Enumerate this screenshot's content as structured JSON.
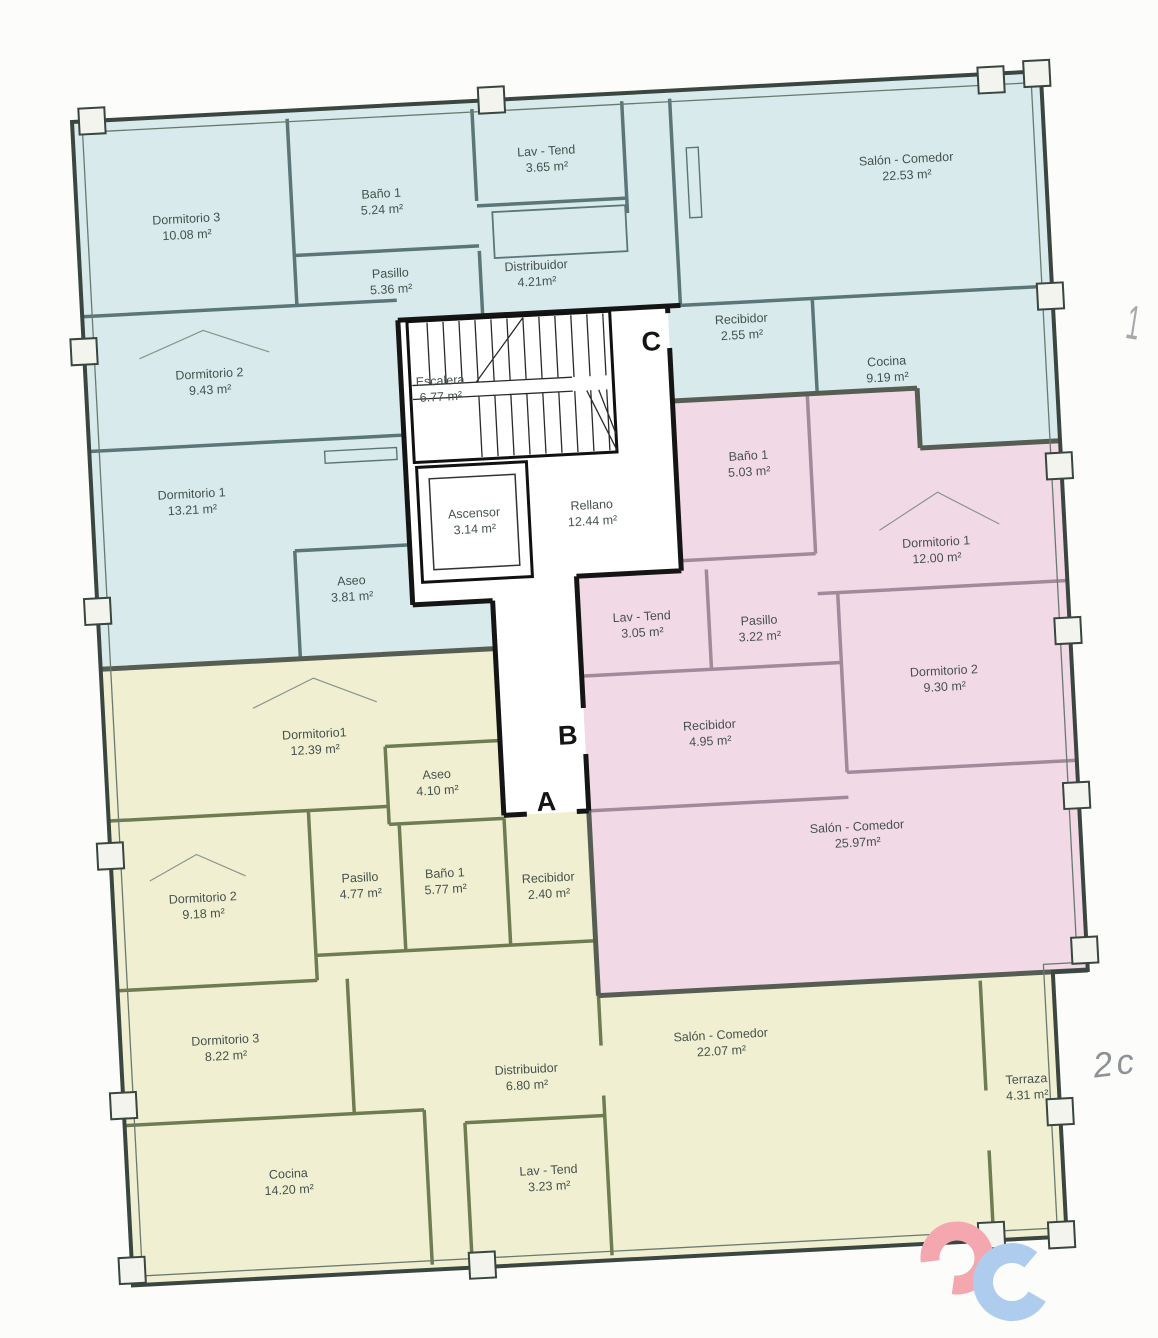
{
  "plan": {
    "letters": {
      "a": "A",
      "b": "B",
      "c": "C"
    },
    "core": {
      "rooms": [
        {
          "name": "Escalera",
          "area": "6.77 m²"
        },
        {
          "name": "Ascensor",
          "area": "3.14 m²"
        },
        {
          "name": "Rellano",
          "area": "12.44 m²"
        }
      ]
    },
    "apartment_c": {
      "fill": "#d9eaec",
      "rooms": [
        {
          "name": "Dormitorio 3",
          "area": "10.08 m²"
        },
        {
          "name": "Baño 1",
          "area": "5.24 m²"
        },
        {
          "name": "Lav - Tend",
          "area": "3.65 m²"
        },
        {
          "name": "Salón - Comedor",
          "area": "22.53 m²"
        },
        {
          "name": "Pasillo",
          "area": "5.36 m²"
        },
        {
          "name": "Distribuidor",
          "area": "4.21m²"
        },
        {
          "name": "Recibidor",
          "area": "2.55 m²"
        },
        {
          "name": "Cocina",
          "area": "9.19 m²"
        },
        {
          "name": "Dormitorio 2",
          "area": "9.43 m²"
        },
        {
          "name": "Dormitorio 1",
          "area": "13.21 m²"
        },
        {
          "name": "Aseo",
          "area": "3.81 m²"
        }
      ]
    },
    "apartment_b": {
      "fill": "#f2d9e6",
      "rooms": [
        {
          "name": "Baño 1",
          "area": "5.03 m²"
        },
        {
          "name": "Dormitorio 1",
          "area": "12.00 m²"
        },
        {
          "name": "Lav - Tend",
          "area": "3.05 m²"
        },
        {
          "name": "Pasillo",
          "area": "3.22 m²"
        },
        {
          "name": "Dormitorio 2",
          "area": "9.30 m²"
        },
        {
          "name": "Recibidor",
          "area": "4.95 m²"
        },
        {
          "name": "Salón - Comedor",
          "area": "25.97m²"
        }
      ]
    },
    "apartment_a": {
      "fill": "#f0efd2",
      "rooms": [
        {
          "name": "Dormitorio1",
          "area": "12.39 m²"
        },
        {
          "name": "Aseo",
          "area": "4.10 m²"
        },
        {
          "name": "Pasillo",
          "area": "4.77 m²"
        },
        {
          "name": "Baño 1",
          "area": "5.77 m²"
        },
        {
          "name": "Dormitorio 2",
          "area": "9.18 m²"
        },
        {
          "name": "Recibidor",
          "area": "2.40 m²"
        },
        {
          "name": "Dormitorio 3",
          "area": "8.22 m²"
        },
        {
          "name": "Cocina",
          "area": "14.20 m²"
        },
        {
          "name": "Distribuidor",
          "area": "6.80 m²"
        },
        {
          "name": "Lav - Tend",
          "area": "3.23 m²"
        },
        {
          "name": "Salón - Comedor",
          "area": "22.07 m²"
        },
        {
          "name": "Terraza",
          "area": "4.31 m²"
        }
      ]
    }
  },
  "annotations": {
    "mark_top_right": "1",
    "mark_right": "2c"
  },
  "logo": {
    "pink": "#f5a7b0",
    "blue": "#aecdee"
  }
}
